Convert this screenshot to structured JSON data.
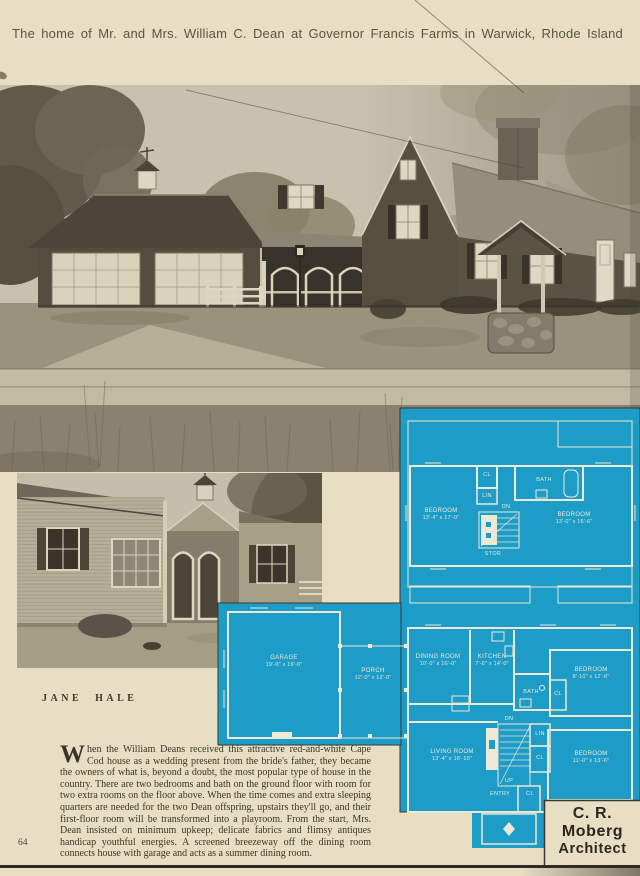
{
  "page": {
    "title": "The home of Mr. and Mrs. William C. Dean at Governor Francis Farms in Warwick, Rhode Island",
    "byline": "JANE HALE",
    "page_number": "64",
    "architect": {
      "line1": "C. R. Moberg",
      "line2": "Architect"
    }
  },
  "article": {
    "drop_cap": "W",
    "body": "hen the William Deans received this attractive red-and-white Cape Cod house as a wedding present from the bride's father, they became the owners of what is, beyond a doubt, the most popular type of house in the country. There are two bedrooms and bath on the ground floor with room for two extra rooms on the floor above. When the time comes and extra sleeping quarters are needed for the two Dean offspring, upstairs they'll go, and their first-floor room will be transformed into a playroom. From the start, Mrs. Dean insisted on minimum upkeep; delicate fabrics and flimsy antiques handicap youthful energies. A screened breezeway off the dining room connects house with garage and acts as a summer dining room."
  },
  "plan": {
    "colors": {
      "plan_blue": "#1d9cc8",
      "plan_line": "#ece8d6",
      "paper": "#e7dec4"
    },
    "upper": {
      "bedroom_left": {
        "label": "BEDROOM",
        "dims": "13'-4\" x 17'-0\""
      },
      "bedroom_right": {
        "label": "BEDROOM",
        "dims": "13'-0\" x 16'-6\""
      },
      "cl": "CL",
      "lin": "LIN",
      "bath": "BATH",
      "dn": "DN",
      "stor": "STOR"
    },
    "lower": {
      "garage": {
        "label": "GARAGE",
        "dims": "19'-0\" x 19'-0\""
      },
      "porch": {
        "label": "PORCH",
        "dims": "12'-0\" x 12'-0\""
      },
      "dining": {
        "label": "DINING ROOM",
        "dims": "10'-0\" x 16'-0\""
      },
      "kitchen": {
        "label": "KITCHEN",
        "dims": "7'-6\" x 14'-0\""
      },
      "bath": "BATH",
      "cl_bath": "CL",
      "bedroom_small": {
        "label": "BEDROOM",
        "dims": "8'-10\" x 12'-8\""
      },
      "living": {
        "label": "LIVING ROOM",
        "dims": "13'-4\" x 16'-10\""
      },
      "bedroom_corner": {
        "label": "BEDROOM",
        "dims": "11'-0\" x 13'-6\""
      },
      "dn": "DN",
      "lin": "LIN",
      "cl_stair": "CL",
      "cl_side": "CL",
      "up": "UP",
      "entry": "ENTRY",
      "cl_entry": "CL"
    }
  }
}
